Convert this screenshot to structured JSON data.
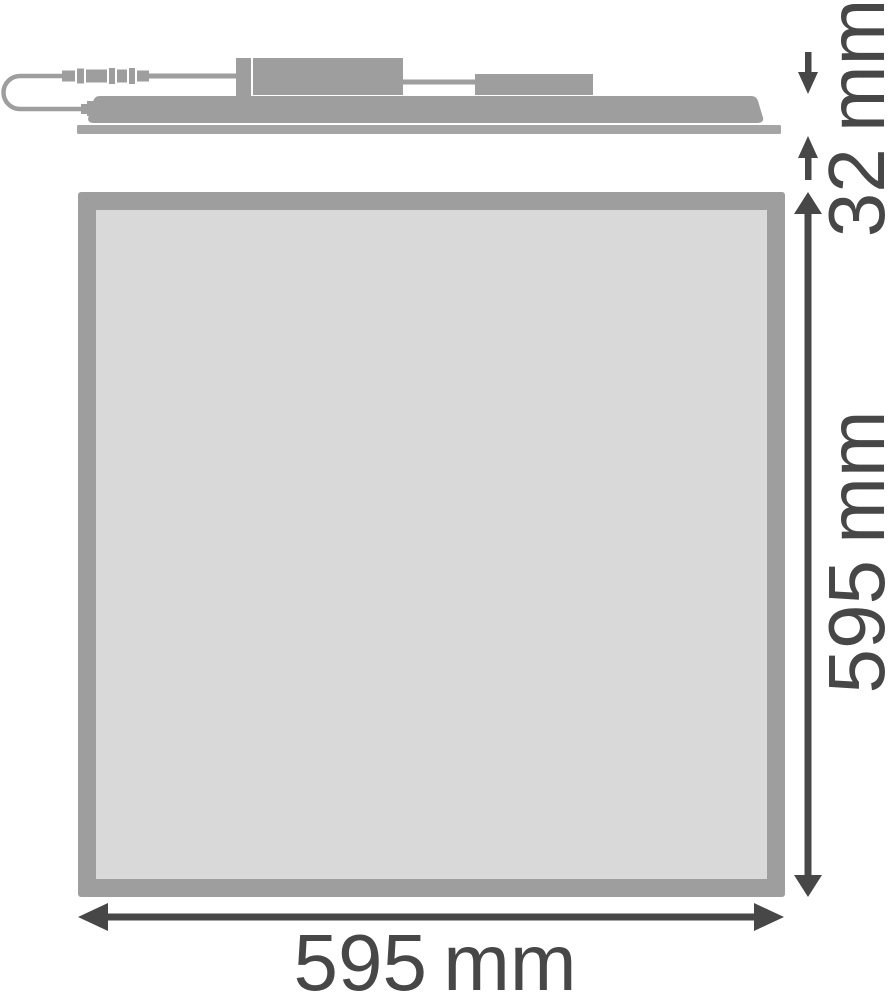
{
  "dimension_labels": {
    "height": "32 mm",
    "side": "595 mm",
    "width": "595 mm"
  },
  "dimension_values_mm": {
    "height": 32,
    "side": 595,
    "width": 595
  },
  "colors": {
    "shape-gray": "#9e9e9e",
    "base-gray": "#a5a5a5",
    "frame-gray": "#9e9e9e",
    "diffuser-gray": "#d9d9d9",
    "dimension-dark": "#474747",
    "background": "#ffffff"
  }
}
